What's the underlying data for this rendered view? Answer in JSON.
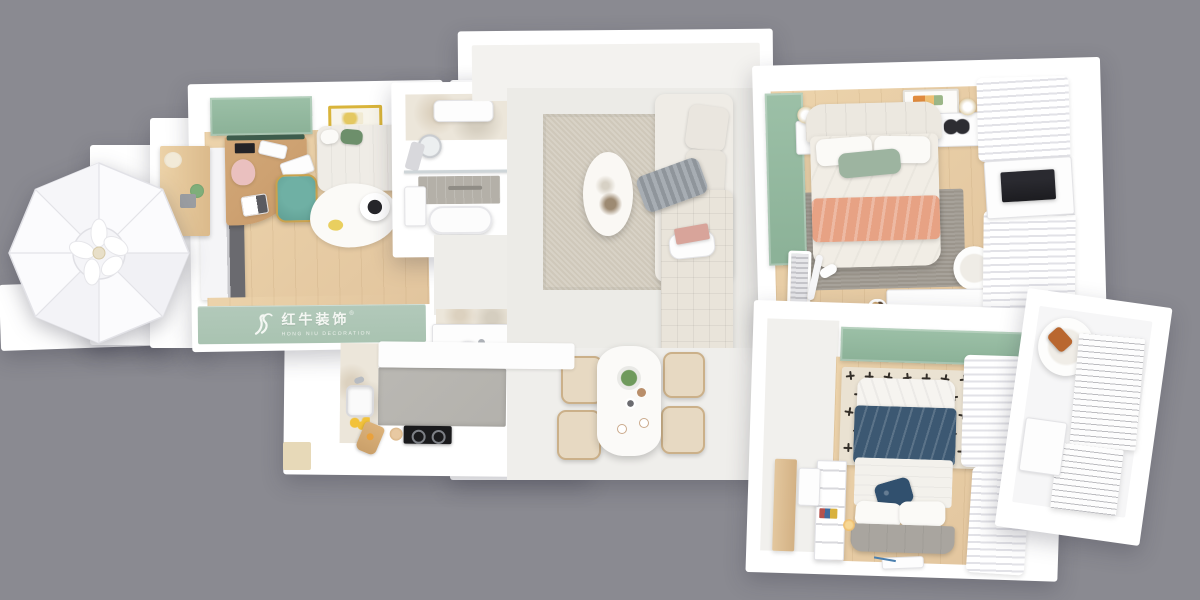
{
  "watermark": {
    "logo": "hongniu-bull-logo",
    "title": "红牛装饰",
    "mark": "®",
    "subtitle": "HONG NIU DECORATION"
  },
  "palette": {
    "background": "#8a8a91",
    "wall_white": "#ffffff",
    "wood_floor": "#e2c59e",
    "wood_desk": "#c89a6a",
    "accent_green": "#8bb197",
    "banner_green": "#a9c3b1",
    "dark_green": "#3d5c4c",
    "teal_chair": "#5f9e93",
    "sofa_cream": "#efece6",
    "rug_beige": "#cfc8ba",
    "rug_gray": "#9b958c",
    "navy": "#3c5872",
    "peach": "#e7a284",
    "star_rug_cream": "#eae2d2",
    "star_mark": "#332e28",
    "yellow_frame": "#d9b43a",
    "lemon_yellow": "#f2c23a",
    "counter_gray": "#b3b1ac",
    "cooktop_black": "#1a1a1c",
    "tv_black": "#1c1c20",
    "orange_pillow": "#b9672f"
  }
}
